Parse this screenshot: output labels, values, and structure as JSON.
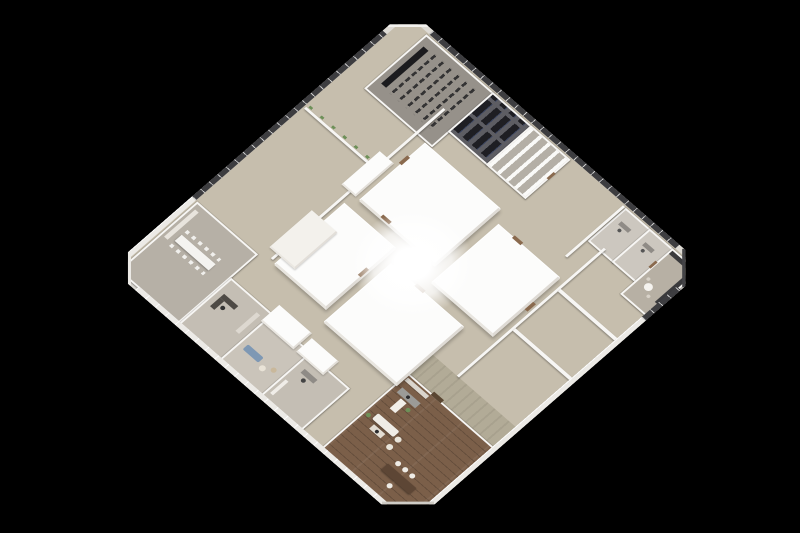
{
  "scene": {
    "type": "3d-isometric-render",
    "subject": "Square office floor plate viewed from above, rotated 45 degrees on a black background",
    "background": "#000000"
  },
  "palette": {
    "bg": "#000000",
    "slab": "#dedbd5",
    "wall": "#f7f6f4",
    "glaze": "#3d3d40",
    "mullion": "#c9c9c9",
    "carpet": "#8e877d",
    "bench": "#f2f1ee",
    "corridor": "#c6bead",
    "corridorGreen": "#b2ab97",
    "wood": "#7b5f49",
    "core": "#fcfcfb",
    "door": "#8a6a4e",
    "sofaBlue": "#7e98b4",
    "plant": "#6d9058",
    "chair": "#6e6e6e",
    "counterDark": "#3a3a3c"
  },
  "rooms": {
    "open_office_nw": {
      "label": "Open-plan office, northwest wing",
      "desk_rows": 11
    },
    "open_office_se": {
      "label": "Open-plan office, southeast wing",
      "desk_rows": 12
    },
    "open_office_north": {
      "label": "Open-plan desks, north-east edge",
      "desk_rows": 5
    },
    "training_room": {
      "label": "Training / town-hall room with chair rows",
      "chair_rows": 6
    },
    "server_room": {
      "label": "Server room with equipment racks",
      "rack_rows": 2
    },
    "archive_room": {
      "label": "Archive / shelving room"
    },
    "office_n1": {
      "label": "Private office"
    },
    "office_n2": {
      "label": "Private office"
    },
    "pantry_corner": {
      "label": "Pantry / kitchenette at east corner"
    },
    "meeting_room_west": {
      "label": "Meeting room at west corner",
      "seats": 6
    },
    "office_w1": {
      "label": "Manager office with bookshelf"
    },
    "lounge_room": {
      "label": "Lounge with blue sofa and poufs",
      "poufs": 2
    },
    "office_w2": {
      "label": "Private office with credenza"
    },
    "executive_suite": {
      "label": "Executive suite with wood floor, desk, sofa set and dining table",
      "dining_stools": 4
    },
    "core_north": {
      "label": "Building core block (north)"
    },
    "core_east": {
      "label": "Building core block (east)"
    },
    "core_south": {
      "label": "Building core block (south)"
    },
    "core_west": {
      "label": "Building core block (west)"
    },
    "central_atrium": {
      "label": "Bright central atrium / skylight"
    },
    "corridor_ring": {
      "label": "Circulation corridor around core"
    }
  }
}
